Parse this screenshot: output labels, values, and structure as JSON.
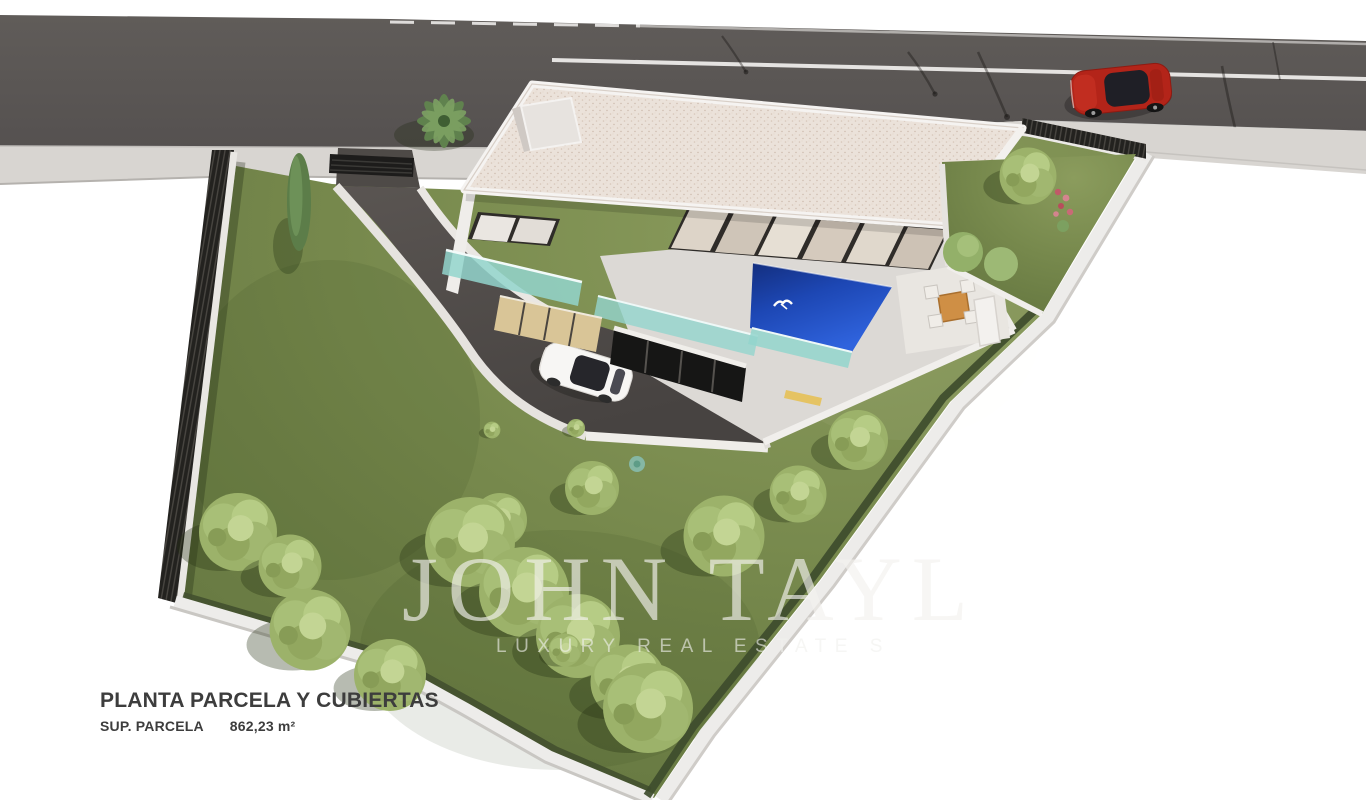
{
  "image": {
    "kind": "architectural-site-plan-render",
    "width_px": 1366,
    "height_px": 800,
    "background": "#ffffff"
  },
  "plan_caption": {
    "title": "PLANTA PARCELA Y CUBIERTAS",
    "area_label": "SUP. PARCELA",
    "area_value": "862,23 m²"
  },
  "watermark": {
    "brand": "JOHN TAYL",
    "tagline": "LUXURY REAL ESTATE S"
  },
  "colors": {
    "background": "#ffffff",
    "road_asphalt": "#5c5855",
    "road_marking": "#f4f3f1",
    "sidewalk": "#d8d5d1",
    "plot_grass": "#76884c",
    "tree_foliage": "#a9bf78",
    "dark_foliage": "#5e814c",
    "hedge": "#3e4c2d",
    "boundary_wall": "#edecea",
    "dark_fence": "#23221f",
    "driveway_asphalt": "#544f4c",
    "villa_wall": "#dcd9d5",
    "roof_gravel": "#ebe2da",
    "glass_balustrade": "#93d5cd",
    "pool_water_deep": "#132e7e",
    "pool_water_bright": "#2f63dd",
    "warm_window": "#d9c597",
    "red_car": "#b32419",
    "white_car": "#f7f6f4",
    "caption_text": "#3d3d3d",
    "watermark_text": "rgba(243,242,238,0.66)"
  },
  "scene_elements": [
    "road",
    "road-center-line",
    "road-edge-line",
    "street-lamp-shadows",
    "sidewalk",
    "street-fence",
    "red-suv-on-road",
    "plot-grass",
    "left-boundary-wall",
    "right-boundary-hedge",
    "bottom-boundary-wall",
    "entrance-gate",
    "curved-driveway",
    "white-car-on-driveway",
    "villa",
    "gravel-flat-roof",
    "roof-bulkhead",
    "upper-window-band",
    "teal-glass-balustrade",
    "warm-ground-windows",
    "garage-opening",
    "infinity-pool",
    "pool-bird",
    "pool-terrace",
    "outdoor-dining-set",
    "outdoor-sofa",
    "side-garden",
    "palm-tree",
    "cypress-tree",
    "garden-trees",
    "flower-plant",
    "agave-plant"
  ]
}
